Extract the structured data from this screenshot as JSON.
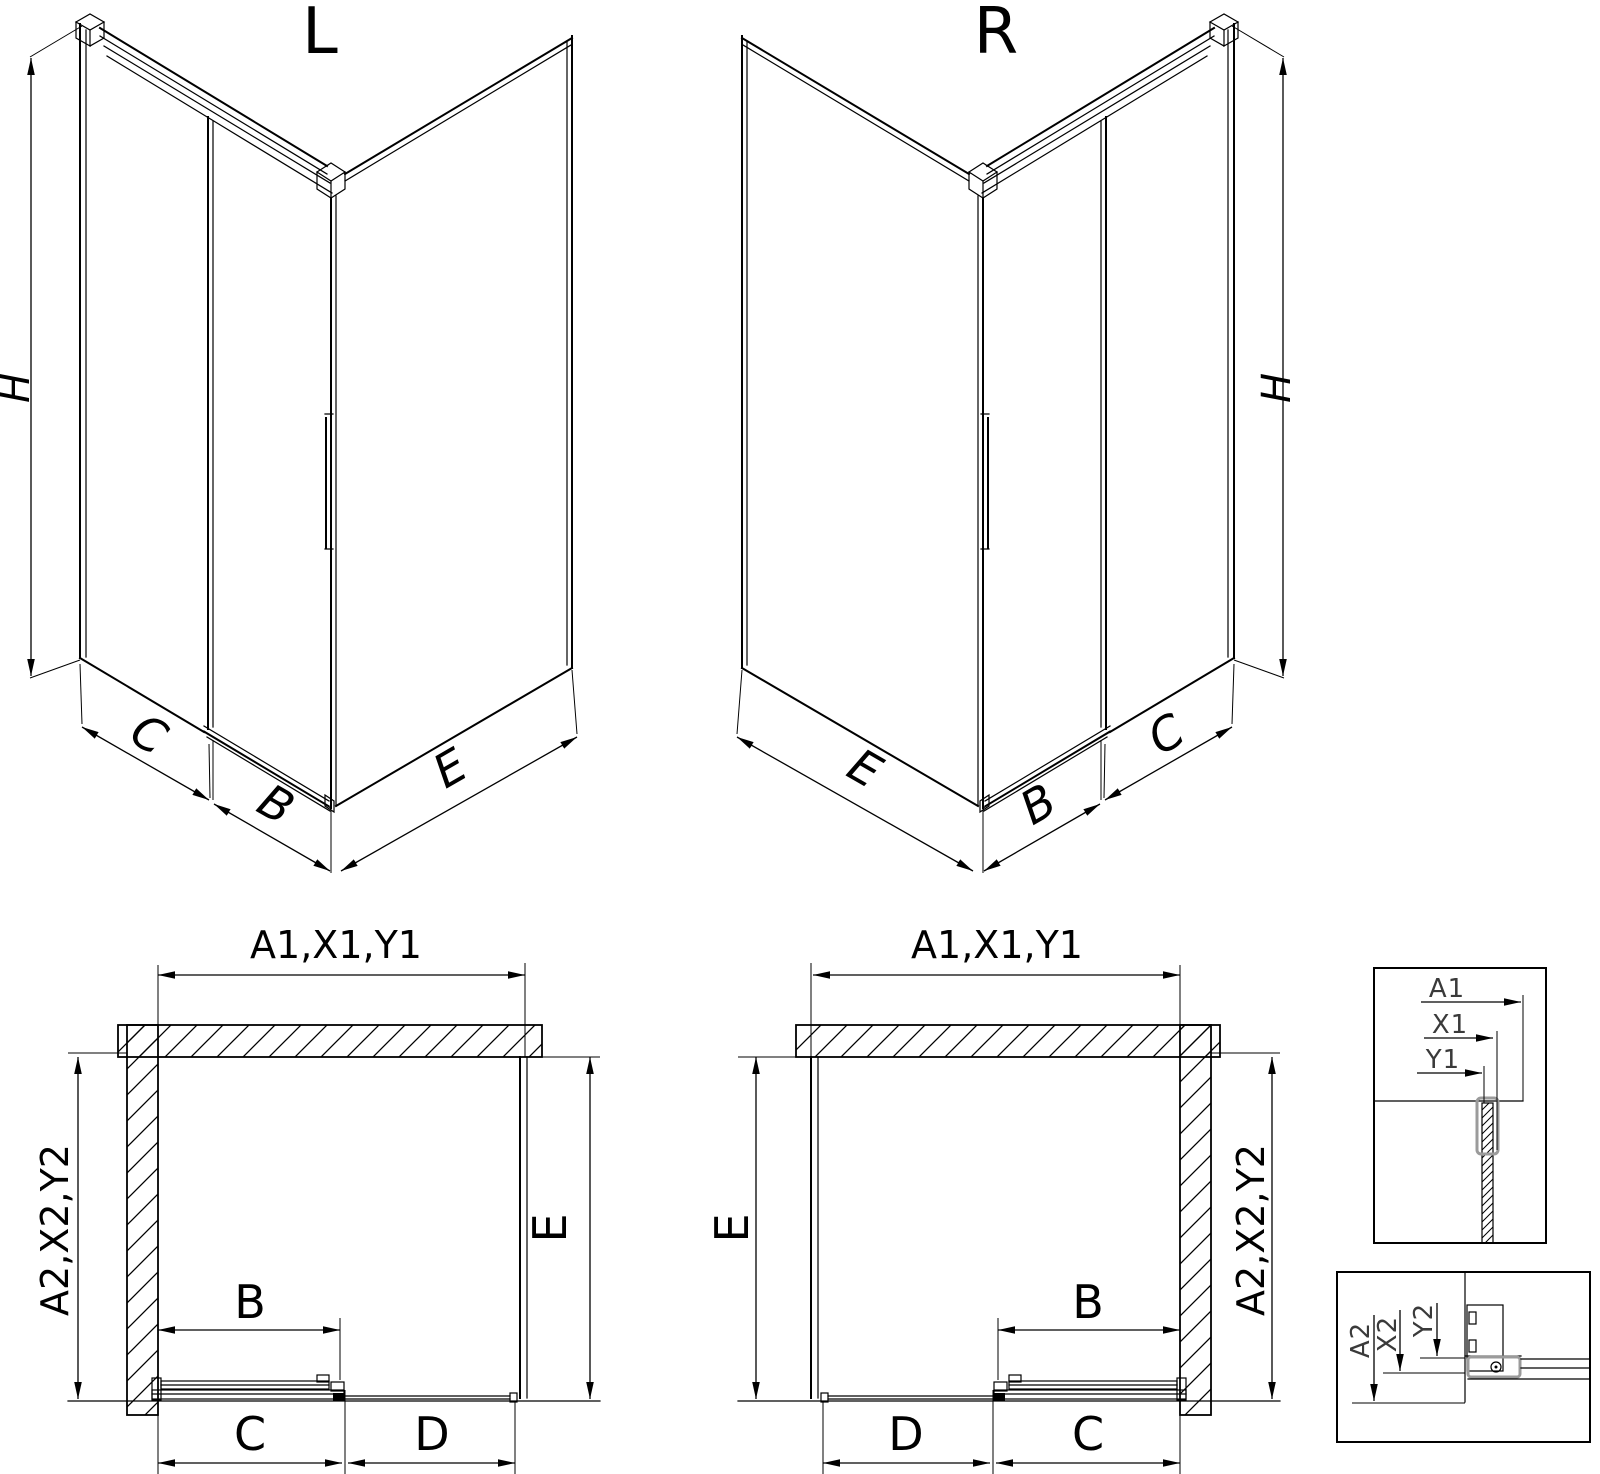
{
  "colors": {
    "line": "#000000",
    "gray": "#9b9b9b",
    "background": "#ffffff"
  },
  "iso_left": {
    "label": "L",
    "height": "H",
    "panel_c": "C",
    "door_b": "B",
    "side_e": "E"
  },
  "iso_right": {
    "label": "R",
    "height": "H",
    "panel_c": "C",
    "door_b": "B",
    "side_e": "E"
  },
  "plan_left": {
    "width": "A1,X1,Y1",
    "depth": "A2,X2,Y2",
    "side_e": "E",
    "opening_b": "B",
    "door_c": "C",
    "fixed_d": "D"
  },
  "plan_right": {
    "width": "A1,X1,Y1",
    "depth": "A2,X2,Y2",
    "side_e": "E",
    "opening_b": "B",
    "door_c": "C",
    "fixed_d": "D"
  },
  "detail_glass_section": {
    "a1": "A1",
    "x1": "X1",
    "y1": "Y1"
  },
  "detail_roller_section": {
    "a2": "A2",
    "x2": "X2",
    "y2": "Y2"
  }
}
